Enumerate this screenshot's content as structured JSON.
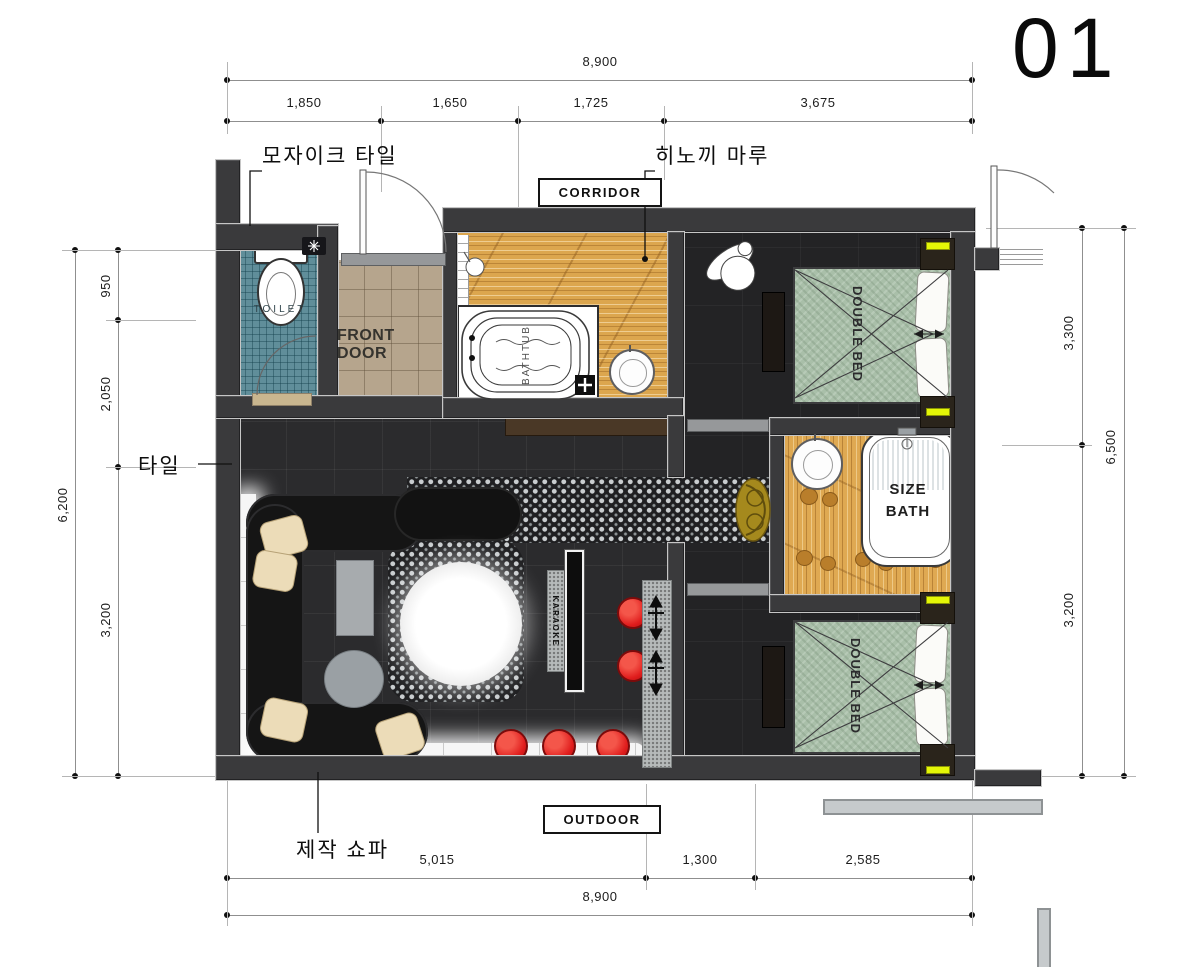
{
  "sheet_number": "01",
  "dims": {
    "top_overall": "8,900",
    "top_segments": [
      "1,850",
      "1,650",
      "1,725",
      "3,675"
    ],
    "left_overall": "6,200",
    "left_segments": [
      "950",
      "2,050",
      "3,200"
    ],
    "right_overall": "6,500",
    "right_segments": [
      "3,300",
      "3,200"
    ],
    "bottom_overall": "8,900",
    "bottom_segments": [
      "5,015",
      "1,300",
      "2,585"
    ]
  },
  "annotations": {
    "mosaic_tile": "모자이크 타일",
    "hinoki_floor": "히노끼 마루",
    "tile": "타일",
    "custom_sofa": "제작 쇼파"
  },
  "rooms": {
    "corridor": "CORRIDOR",
    "outdoor": "OUTDOOR",
    "toilet": "TOILET",
    "front_door": "FRONT DOOR",
    "bathtub": "BATHTUB",
    "double_bed_upper": "DOUBLE BED",
    "double_bed_lower": "DOUBLE BED",
    "size_bath": "SIZE BATH",
    "karaoke": "KARAOKE"
  },
  "colors": {
    "wall": "#3a3a3c",
    "wood_floor": "#dca64e",
    "mosaic_teal": "#608e9a",
    "entry_tile": "#b6a58d",
    "dark_floor": "#2b2b2d",
    "bed_fabric": "#a9bfa9",
    "accent_yellow": "#e4f607",
    "stool_red": "#e01d1d",
    "granite": "#b6baba",
    "olive_chair": "#a5891d",
    "cushion_cream": "#ecdcb8"
  }
}
